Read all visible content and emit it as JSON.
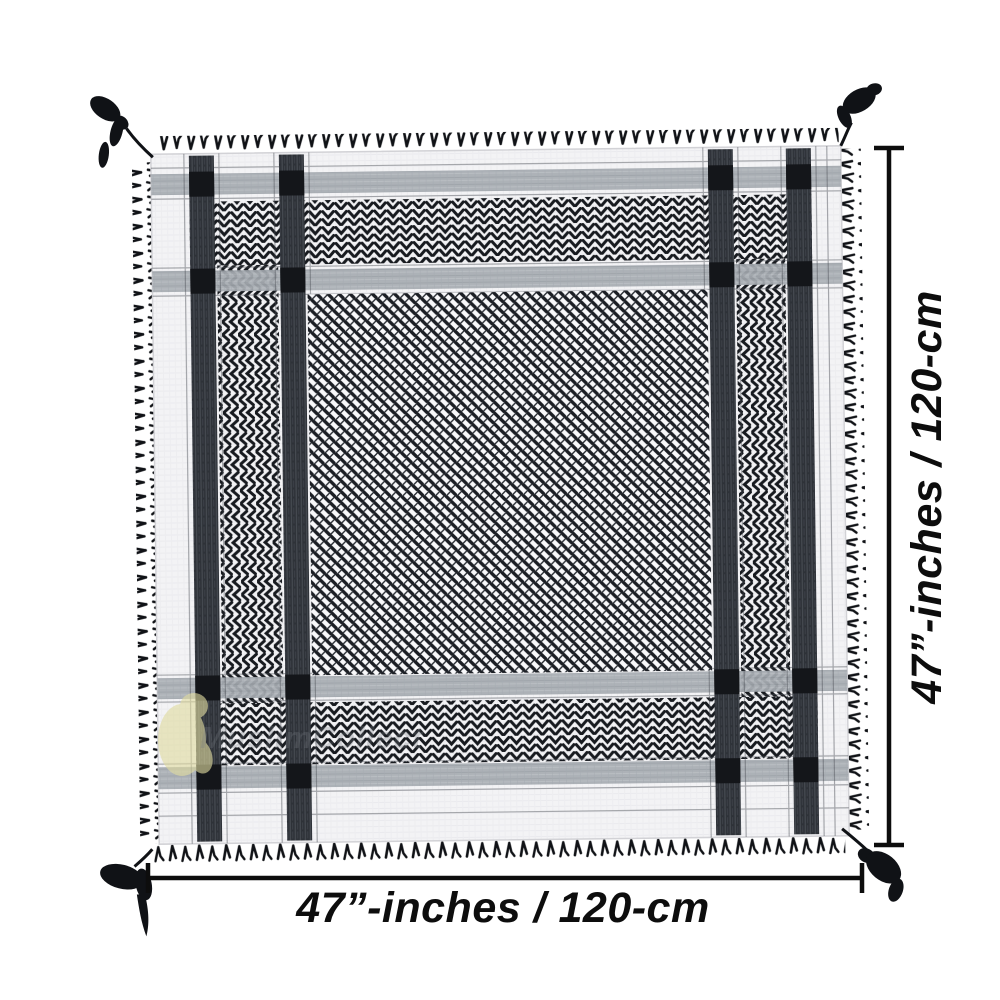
{
  "page": {
    "background_color": "#ffffff"
  },
  "product_photo": {
    "subject": "Black and white shemagh keffiyeh scarf laid flat, with fringed edges and braided corner tassels",
    "watermark_text": "MuslimCollect",
    "dimensions": {
      "width_label": "47”-inches / 120-cm",
      "height_label": "47”-inches / 120-cm"
    },
    "colors": {
      "fabric_white": "#f3f3f5",
      "pattern_black": "#1b1e24",
      "band_gray": "#a7acb2",
      "stripe_charcoal": "#2e3238",
      "annotation_black": "#0d0d0d",
      "watermark_yellow": "#e0dba0"
    }
  }
}
